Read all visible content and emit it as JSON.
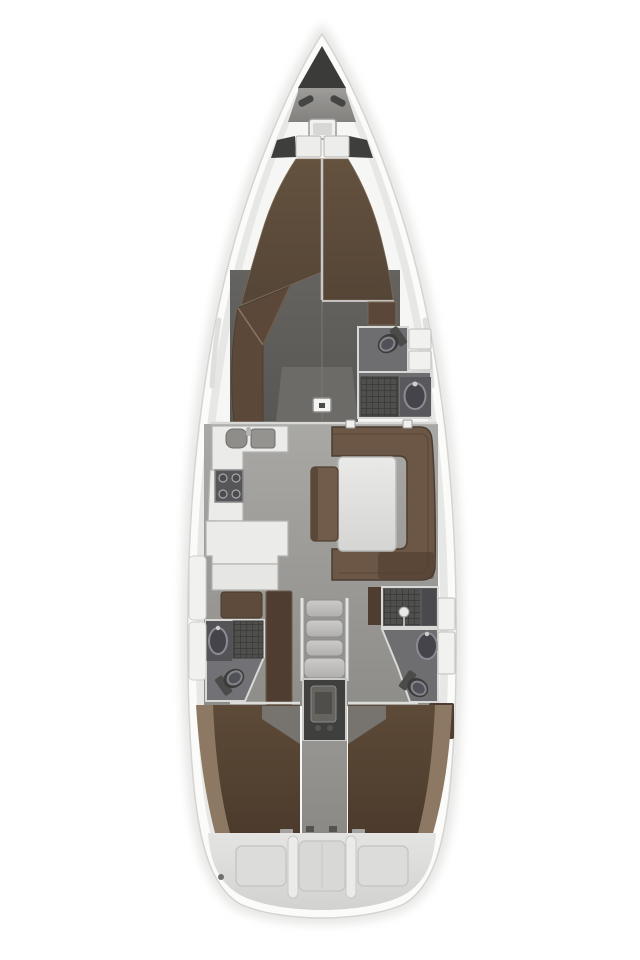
{
  "meta": {
    "title": "Sailing yacht interior floor plan, top-down view",
    "type": "boat-floor-plan"
  },
  "areas": {
    "hull": "Hull and side decks",
    "bow": "Bow with anchor locker, cleats and deck hatch",
    "forward_cabin": "Forward cabin with V-berth and wardrobe",
    "forward_head": "Forward bathroom with toilet, shower and sink",
    "salon": "Salon",
    "galley": "Port galley with double sink, stove and counters",
    "dinette": "Starboard U-shaped sofa with table and bench",
    "nav_station": "Navigation desk and seat",
    "aft_head_port": "Port aft bathroom with sink, shower and toilet",
    "aft_head_starboard": "Starboard aft bathroom with shower, sink and toilet",
    "companionway": "Companionway steps over engine compartment",
    "aft_cabin_port": "Port aft cabin with double berth",
    "aft_cabin_starboard": "Starboard aft cabin with double berth",
    "stern": "Stern with transom lockers and swim platform"
  },
  "colors": {
    "background": "#ffffff",
    "hull_white": "#fbfbfa",
    "hull_outline": "#d4d4d2",
    "gunwale": "#e7e7e5",
    "side_deck": "#f6f6f4",
    "anchor_locker": "#3b3b39",
    "cleat": "#454543",
    "hatch_frame": "#f1f1ef",
    "hatch_glass": "#d7d7d5",
    "shelf_white": "#ededeb",
    "corner_wedge": "#3e3e3c",
    "berth_divider": "#c9c9c7",
    "bedside_brown": "#5a4739",
    "wardrobe_brown": "#5c4839",
    "wardrobe_seam": "#8a7663",
    "door_marker": "#f4f4f2",
    "head_floor": "#6e6d70",
    "head_floor_light": "#727175",
    "toilet_body": "#3c3c3a",
    "toilet_tank": "#4b4b49",
    "shower_grate": "#4f4f4d",
    "sink_dark": "#45444a",
    "sink_rim": "#8b8b93",
    "sink_cabinet": "#545358",
    "locker_white": "#f1f1ef",
    "wall_line": "#d8d8d6",
    "counter_white": "#ebebe9",
    "counter_edge": "#b2b2b0",
    "basin_gray": "#8e8d89",
    "stove_dark": "#56555a",
    "sofa_brown": "#6c5646",
    "sofa_border": "#4b3c31",
    "sofa_dark_patch": "#4e3c2e",
    "bench_brown": "#715c4b",
    "nav_seat_brown": "#5f4b3c",
    "steps_rail": "#e3e3e1",
    "engine_room": "#3f3f3d",
    "engine_block": "#65645f",
    "aft_berth_tan": "#8d7963",
    "aft_floor_gray": "#7a7976",
    "transom_panel": "#c7c7c5",
    "white_divider": "#ebebe9",
    "shower_head": "#e9e9e7"
  }
}
